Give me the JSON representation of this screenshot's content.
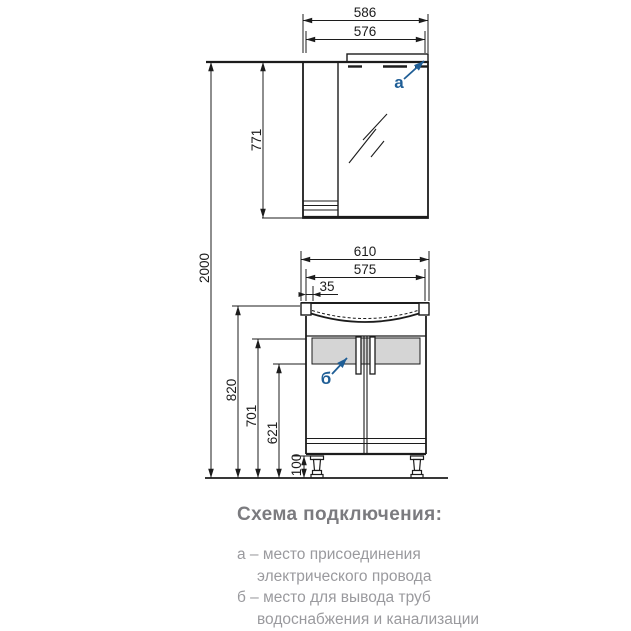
{
  "drawing_title": "Схема подключения:",
  "dimensions": {
    "mirror_width_outer": "586",
    "mirror_width_inner": "576",
    "mirror_height": "771",
    "total_height": "2000",
    "basin_width": "610",
    "vanity_width": "575",
    "basin_offset": "35",
    "vanity_height": "820",
    "pipe_zone_top": "701",
    "pipe_zone_bottom": "621",
    "leg_height": "100"
  },
  "callouts": {
    "electric": "а",
    "pipes": "б"
  },
  "legend": [
    {
      "line1": "а – место присоединения",
      "line2": "электрического провода"
    },
    {
      "line1": "б – место для вывода труб",
      "line2": "водоснабжения и канализации"
    }
  ],
  "colors": {
    "line": "#1c1c1c",
    "callout_blue": "#1f5e96",
    "pipe_zone_gray": "#d5d5d5",
    "title_gray": "#7b7b7f",
    "legend_gray": "#9a9a9e"
  }
}
